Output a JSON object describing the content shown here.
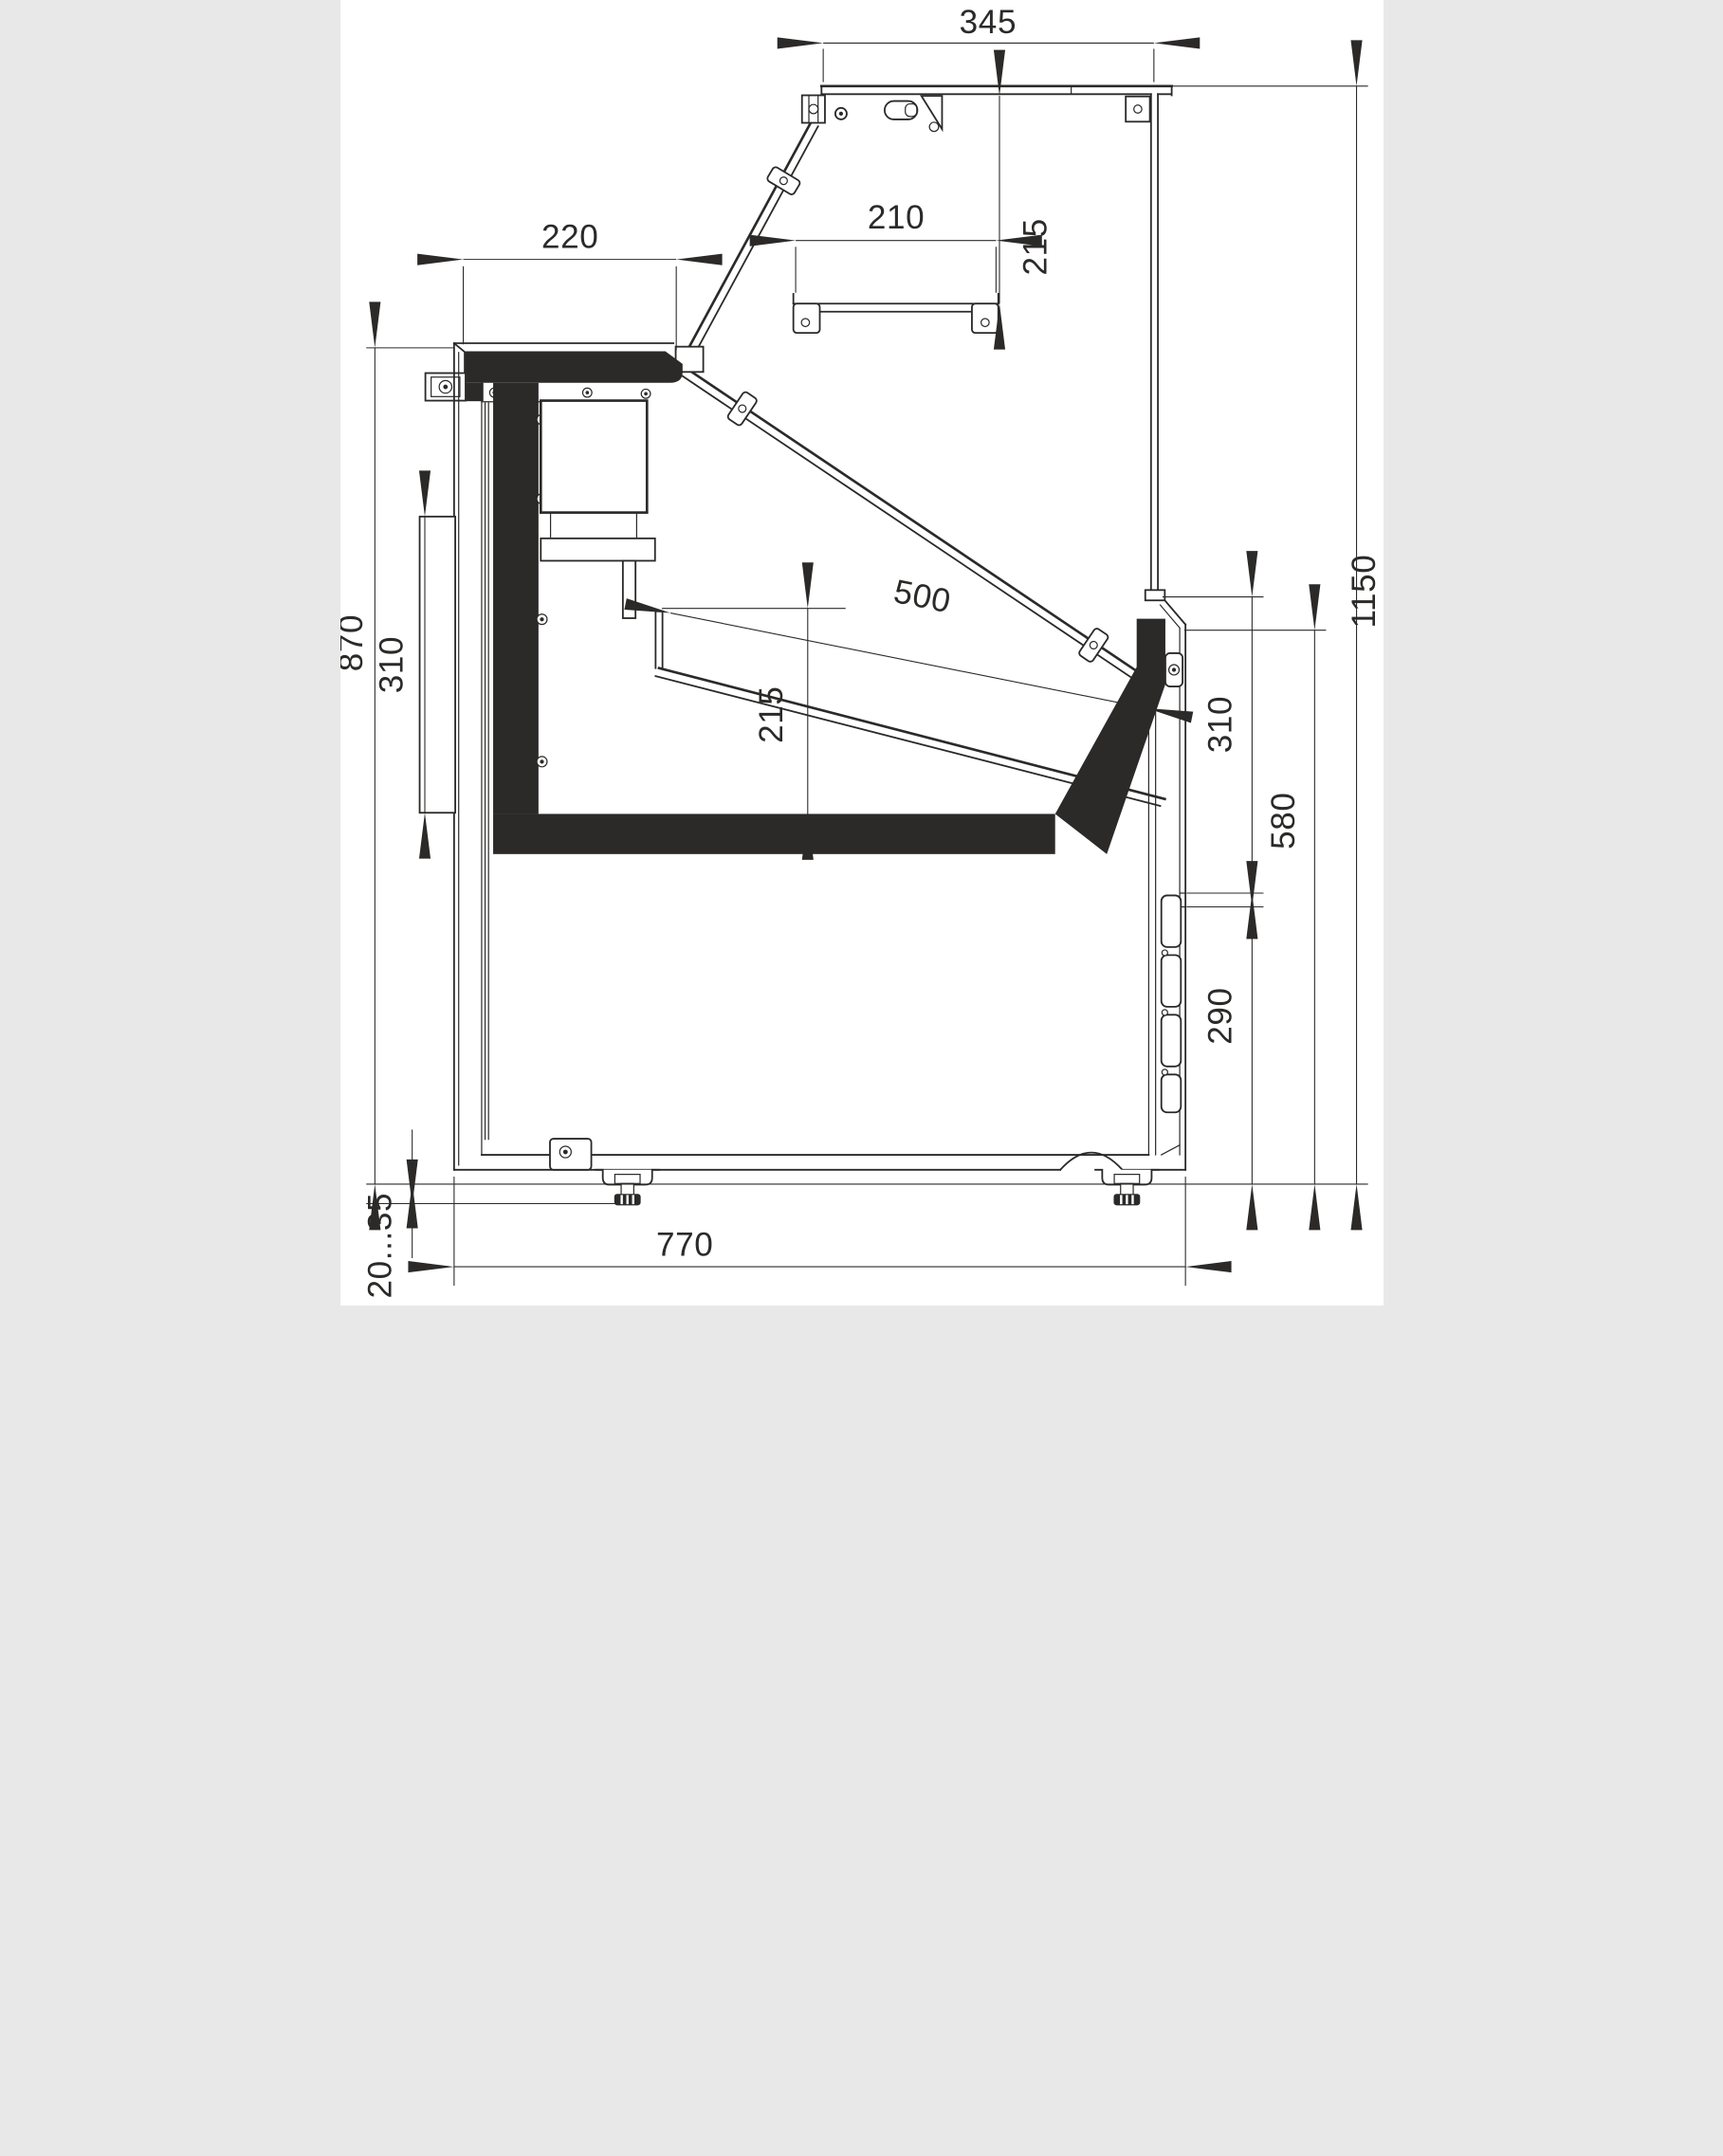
{
  "drawing": {
    "type": "technical-cross-section",
    "subject": "refrigerated serve-over display counter, side section with dimensions",
    "units": "mm",
    "colors": {
      "line": "#2b2a29",
      "background": "#ffffff"
    },
    "dims": {
      "top_depth": "345",
      "canopy_to_shelf": "215",
      "worktop_depth": "220",
      "shelf_width": "210",
      "display_opening": "500",
      "rear_bumper_height": "310",
      "worktop_height": "870",
      "well_inner_depth": "215",
      "overall_height": "1150",
      "glass_to_grille": "310",
      "front_lower_height": "580",
      "grille_height": "290",
      "base_depth": "770",
      "foot_adjust_range": "20...35"
    }
  }
}
